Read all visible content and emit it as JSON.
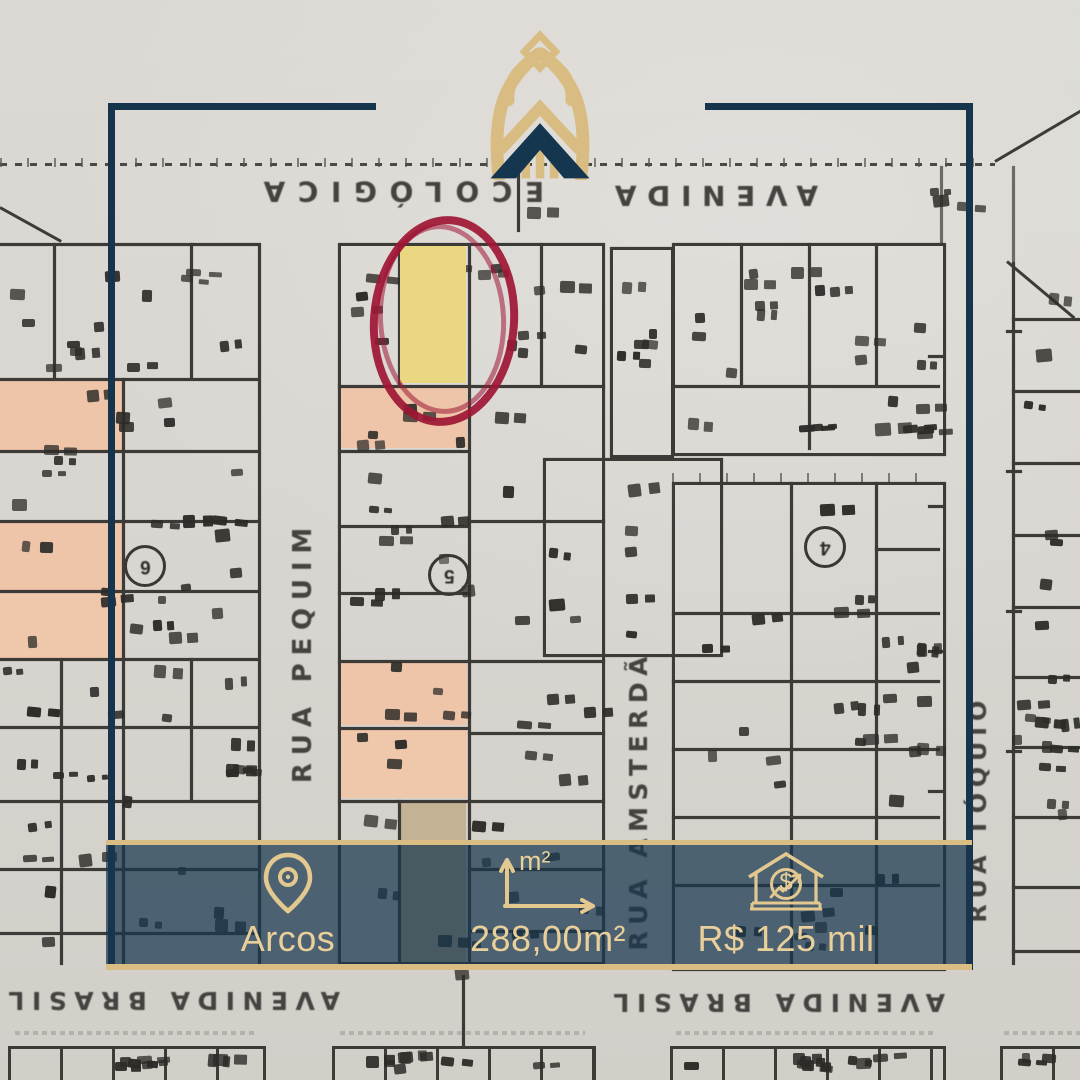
{
  "brand": {
    "logo_name": "crown-monogram-logo"
  },
  "map": {
    "street_labels": {
      "top_avenue_word_left": "ECOLÓGICA",
      "top_avenue_word_right": "AVENIDA",
      "rua_pequim": "RUA PEQUIM",
      "rua_amsterda": "RUA AMSTERDÃ",
      "rua_toquio": "RUA TÓQUIO",
      "avenida_brasil_left": "AVENIDA BRASIL",
      "avenida_brasil_right": "AVENIDA BRASIL"
    },
    "block_markers": [
      {
        "label": "6"
      },
      {
        "label": "5"
      },
      {
        "label": "4"
      }
    ],
    "highlighted_lot": {
      "marker": "hand-drawn-red-ellipse",
      "fill": "yellow"
    }
  },
  "banner": {
    "location": {
      "icon": "location-pin-icon",
      "label": "Arcos"
    },
    "area": {
      "icon": "area-arrows-icon",
      "icon_label": "m²",
      "value": "288,00m²"
    },
    "price": {
      "icon": "house-dollar-icon",
      "dollar_glyph": "$",
      "value": "R$ 125 mil"
    }
  },
  "colors": {
    "navy": "#16354d",
    "gold": "#d9bd83",
    "banner_text_gold": "#e9cf9a",
    "red_circle": "#9e1736",
    "salmon_lot": "#eec5a8",
    "yellow_lot": "#e9d782"
  }
}
